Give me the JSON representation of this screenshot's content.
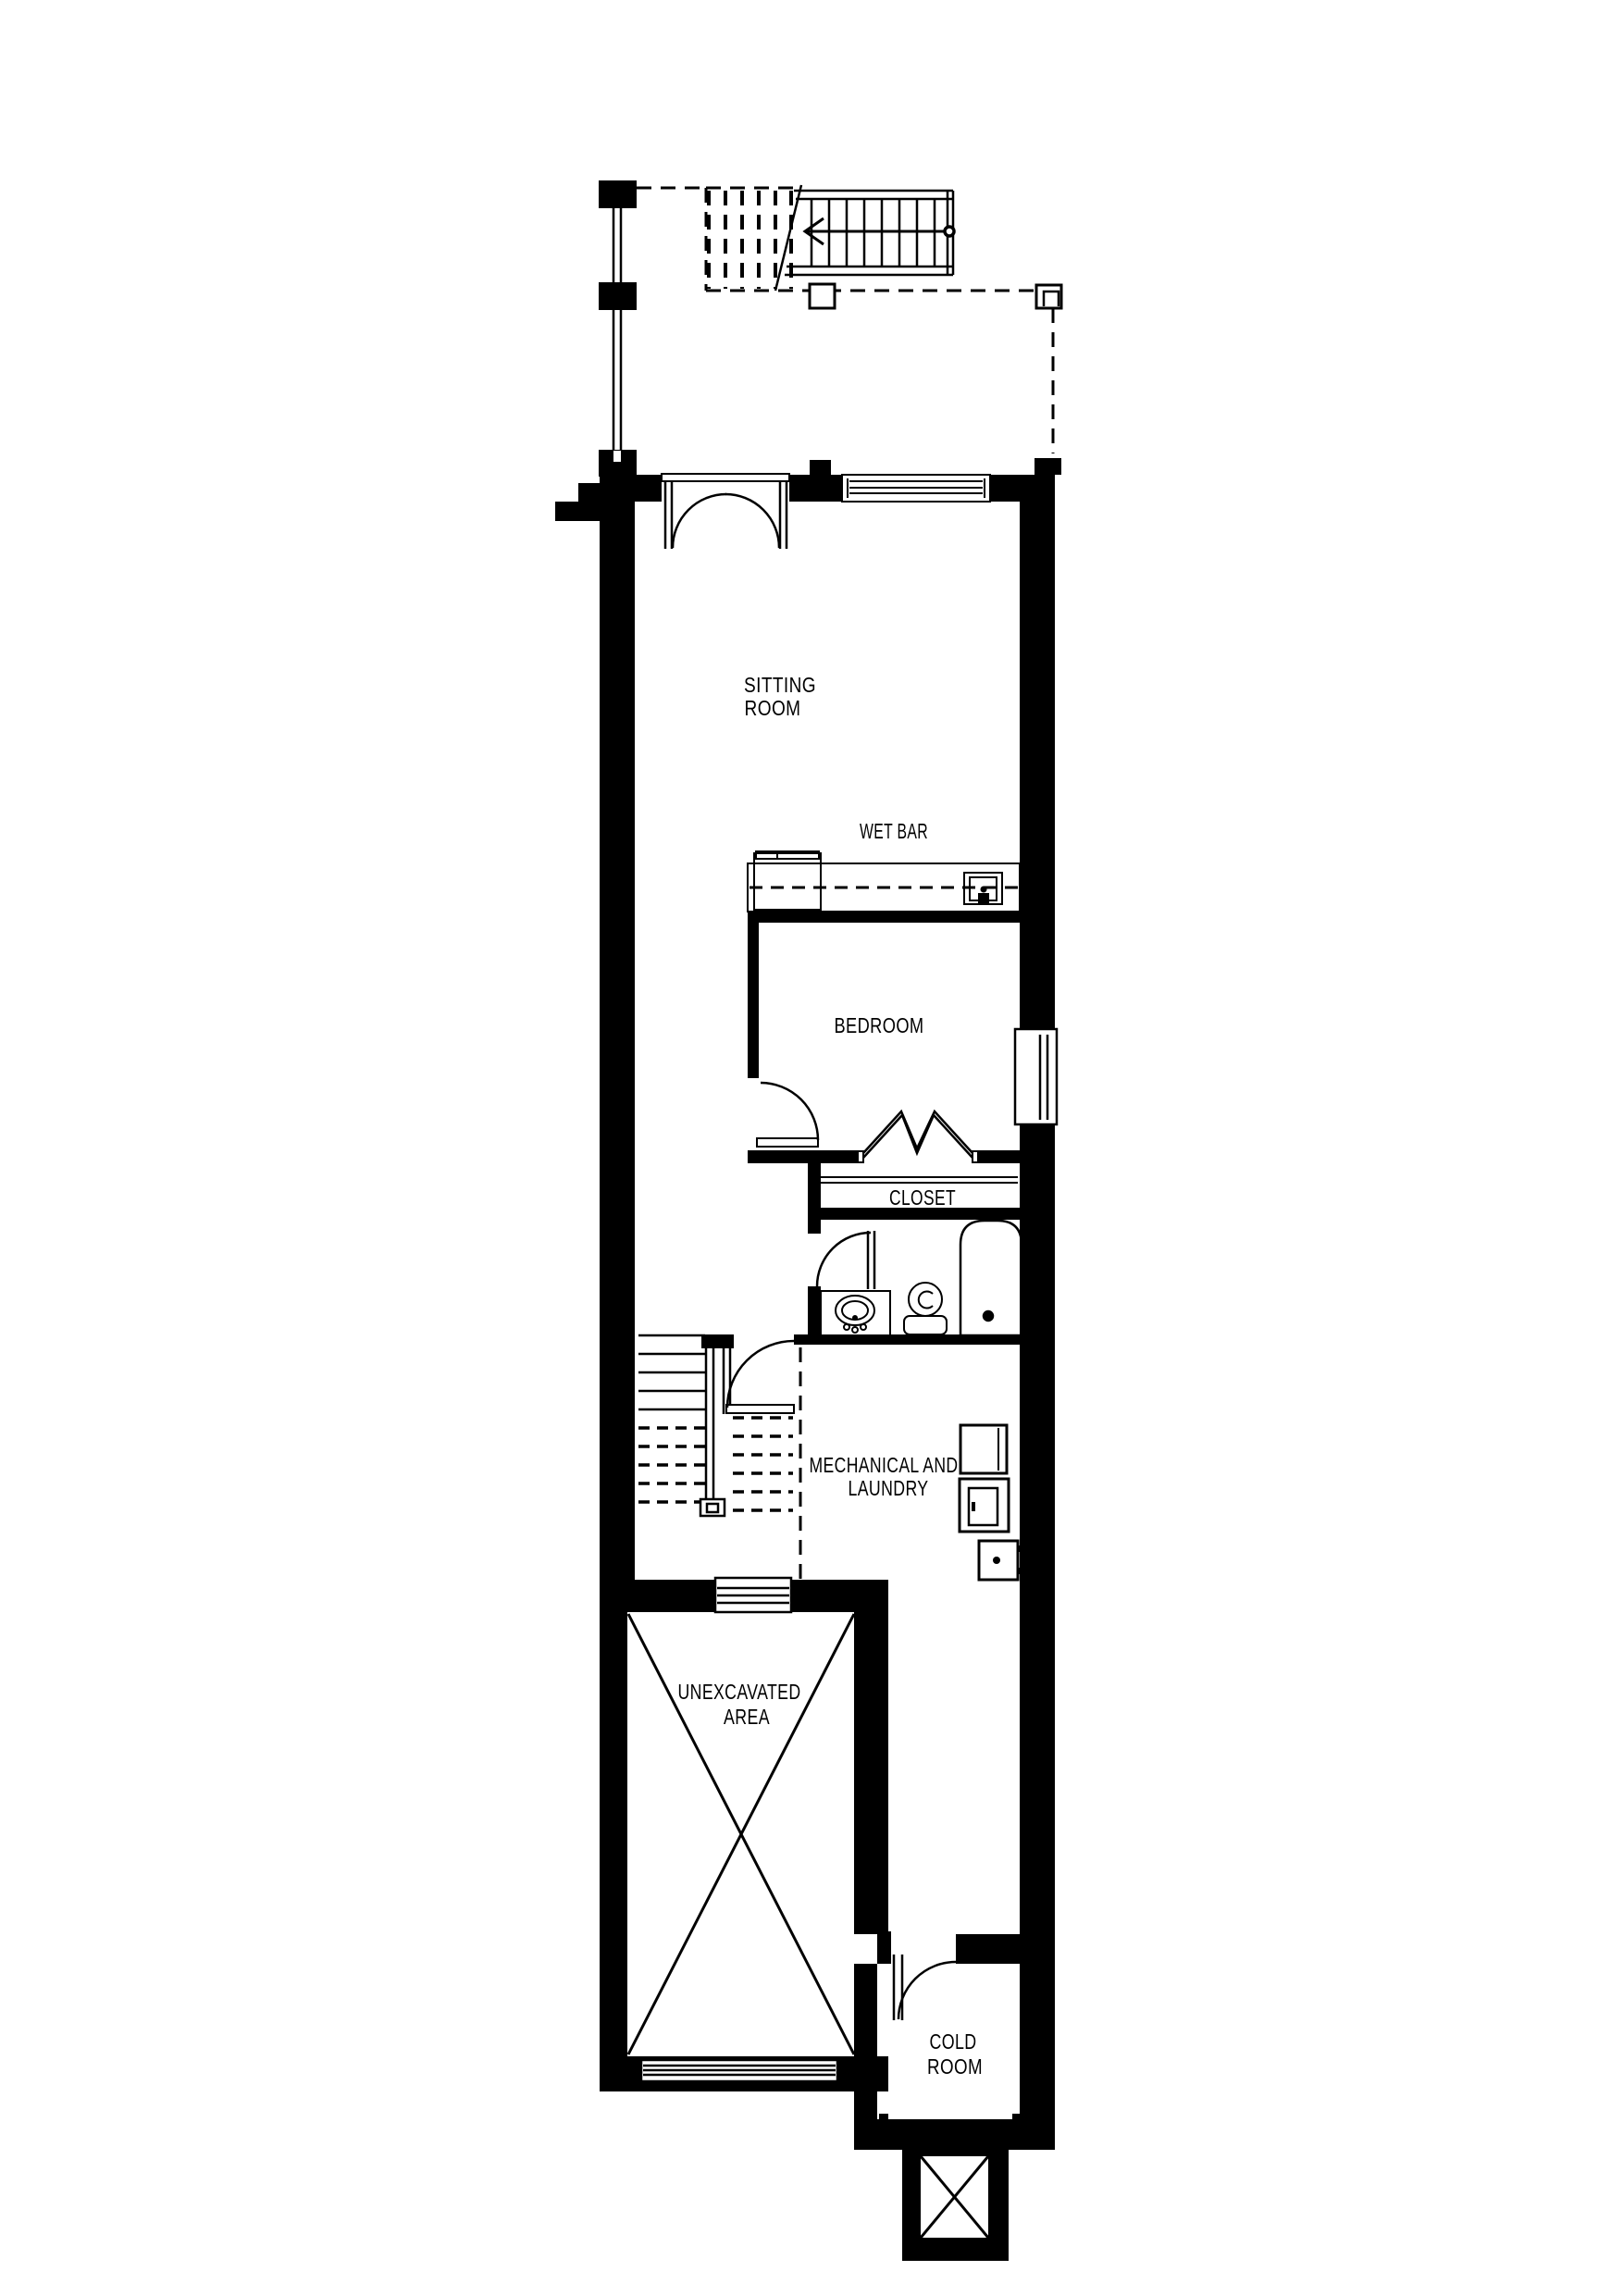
{
  "document": {
    "type": "basement floor plan drawing"
  },
  "labels": {
    "sitting_room_line1": "SITTING",
    "sitting_room_line2": "ROOM",
    "wet_bar": "WET BAR",
    "bedroom": "BEDROOM",
    "closet": "CLOSET",
    "mechanical_line1": "MECHANICAL AND",
    "mechanical_line2": "LAUNDRY",
    "unexcavated_line1": "UNEXCAVATED",
    "unexcavated_line2": "AREA",
    "cold_room_line1": "COLD",
    "cold_room_line2": "ROOM"
  },
  "colors": {
    "wall": "#000000",
    "background": "#ffffff",
    "line": "#000000"
  }
}
